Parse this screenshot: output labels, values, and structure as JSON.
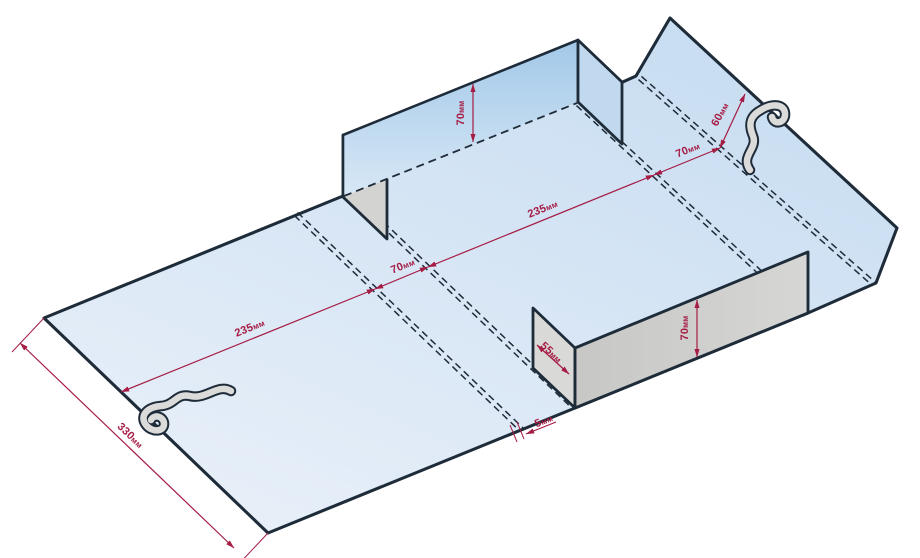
{
  "dimensions": {
    "left_panel": {
      "value": "235",
      "unit": "мм"
    },
    "left_gap": {
      "value": "70",
      "unit": "мм"
    },
    "center_panel": {
      "value": "235",
      "unit": "мм"
    },
    "right_gap": {
      "value": "70",
      "unit": "мм"
    },
    "top_flap": {
      "value": "60",
      "unit": "мм"
    },
    "back_wall_height": {
      "value": "70",
      "unit": "мм"
    },
    "front_wall_height": {
      "value": "70",
      "unit": "мм"
    },
    "end_flap": {
      "value": "55",
      "unit": "мм"
    },
    "edge_step": {
      "value": "5",
      "unit": "мм"
    },
    "blank_width": {
      "value": "330",
      "unit": "мм"
    }
  },
  "colors": {
    "outline": "#1e2b39",
    "dimension": "#a51c44",
    "sheet_deep": "#c6dcf1",
    "sheet_light": "#e9f0f9",
    "wall_blue_top": "#a2c8e8",
    "wall_blue_bottom": "#d8e8f6",
    "wall_blue_flap": "#c0d9ee",
    "gray_face_dark": "#c7c7c5",
    "gray_face_light": "#d6d6d4",
    "gray_flap": "#d3d3d1",
    "gray_flap_light": "#d9d9d7",
    "hook_fill": "#dbdbd9"
  }
}
